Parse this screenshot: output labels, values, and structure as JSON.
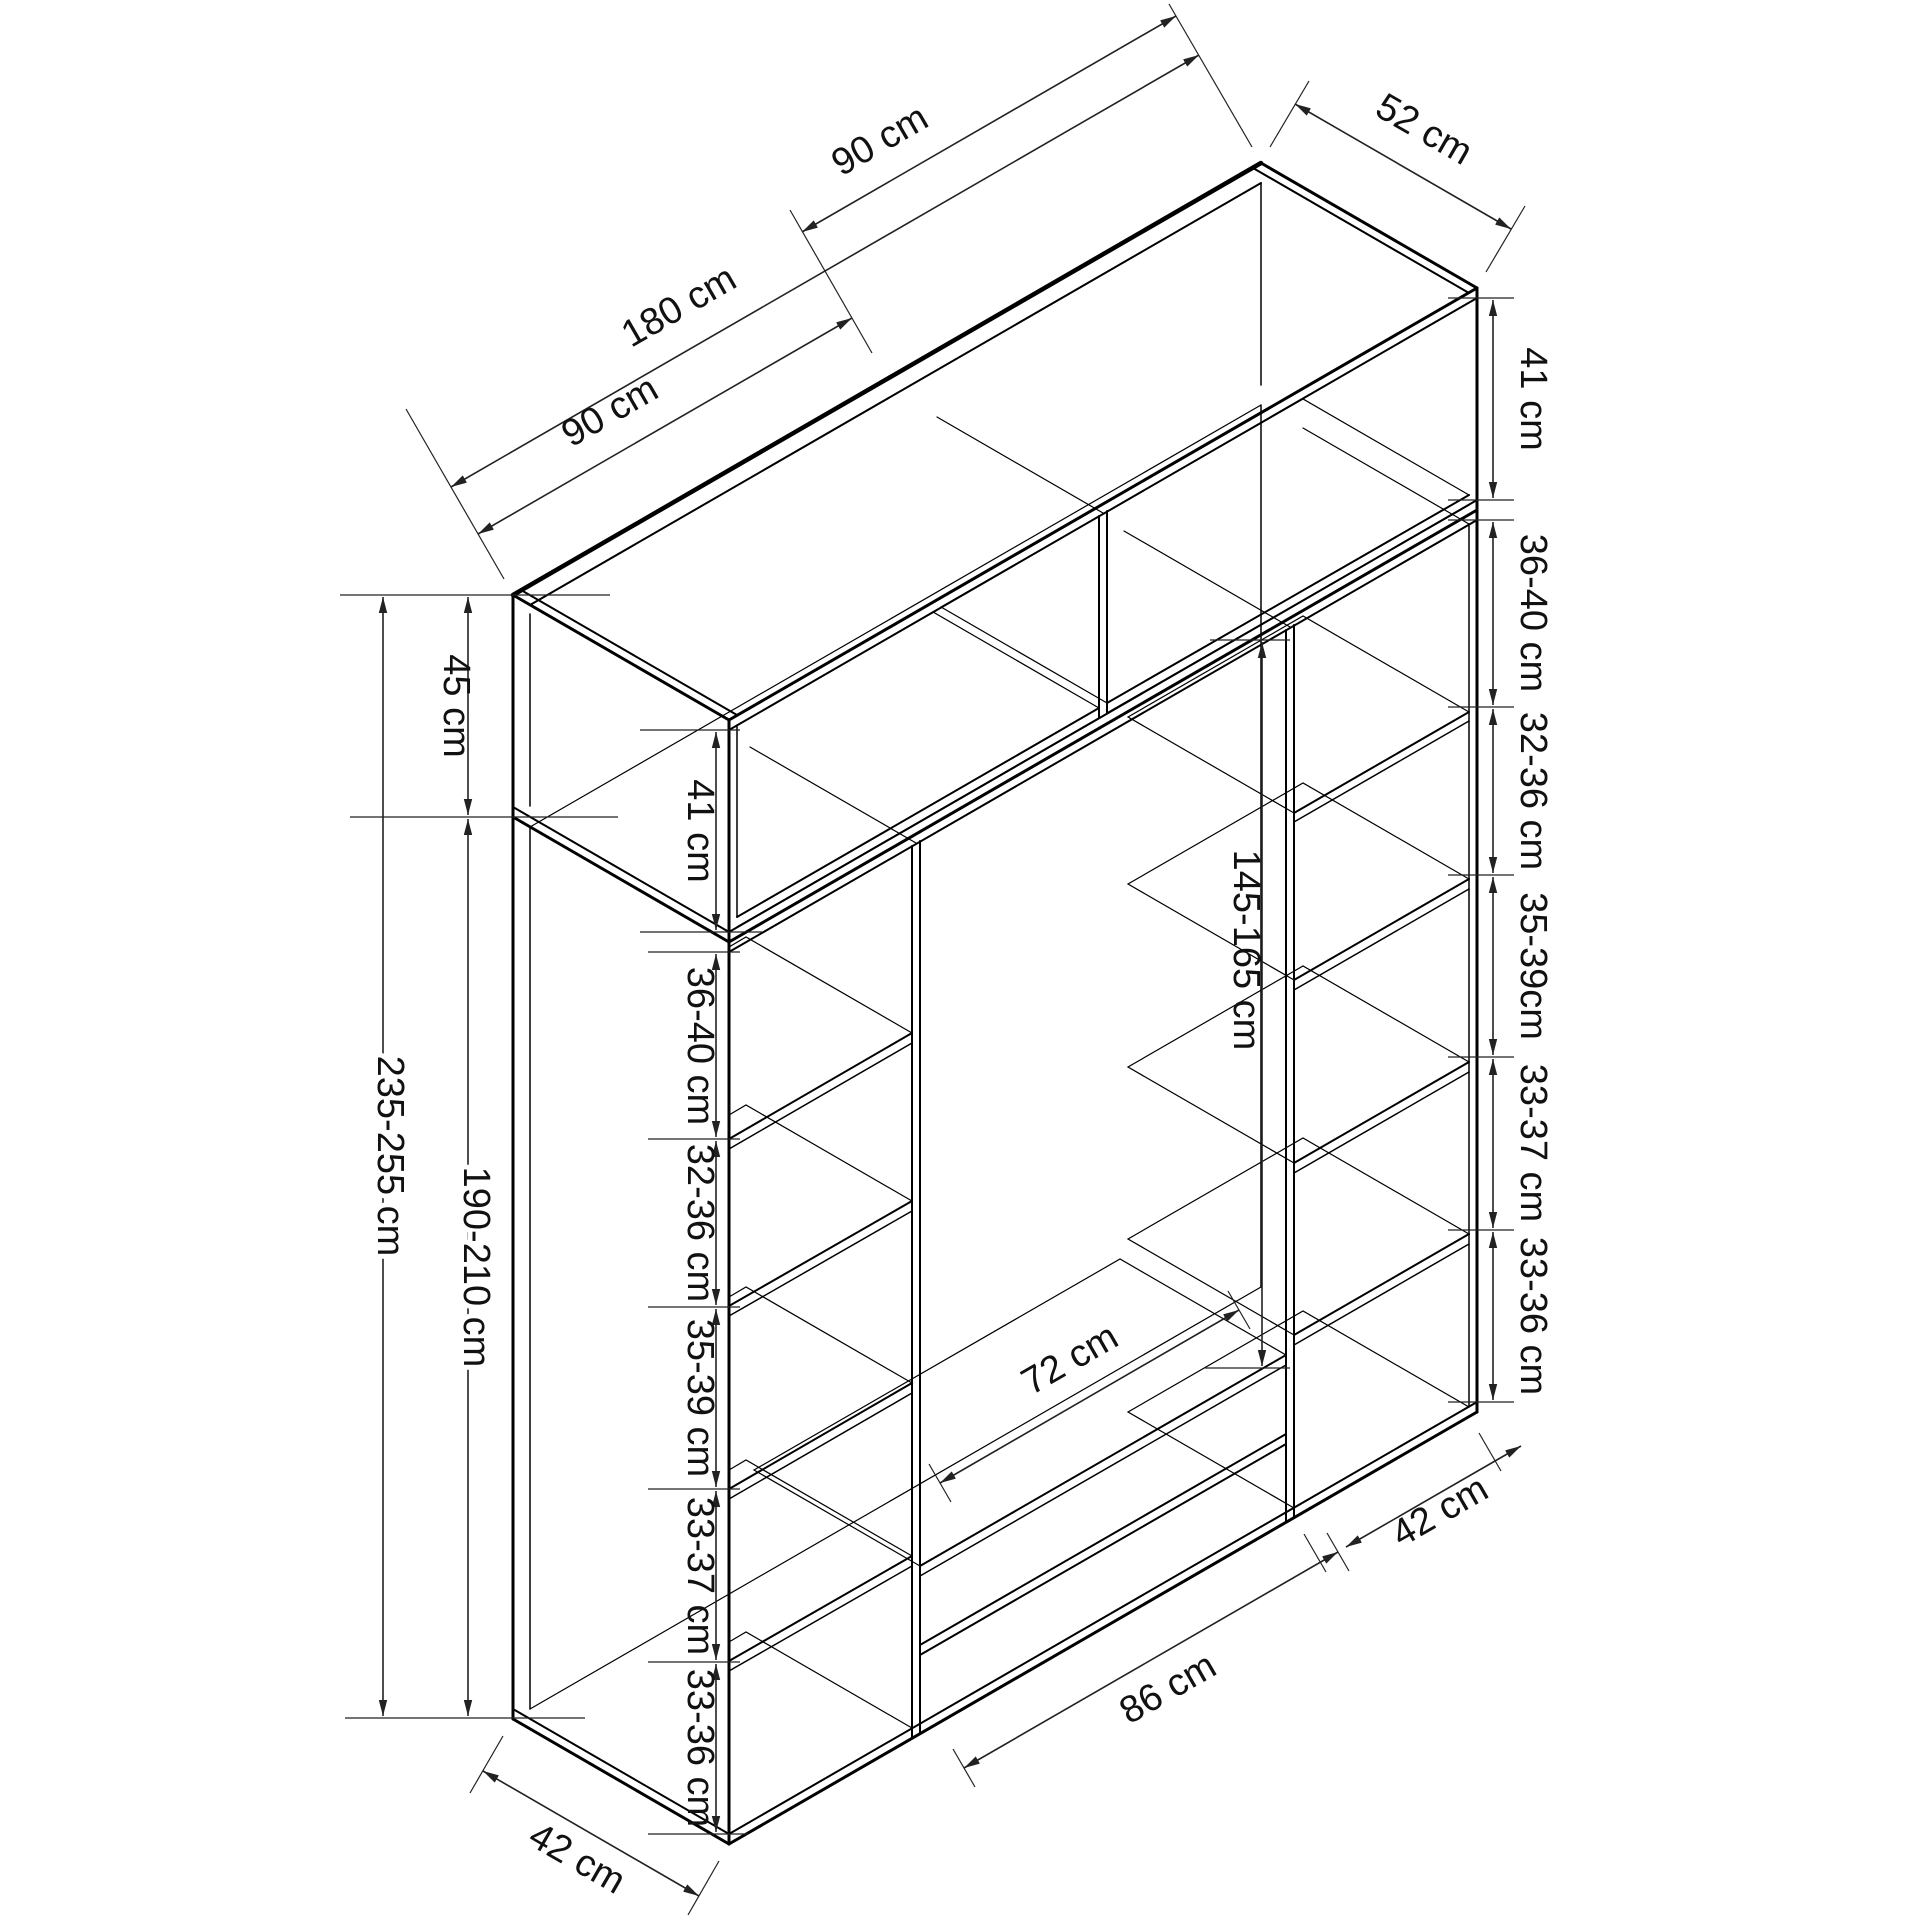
{
  "diagram": {
    "kind": "wardrobe-dimension-drawing",
    "unit": "cm",
    "top": {
      "left_half": "90 cm",
      "total": "180 cm",
      "right_half": "90 cm",
      "depth": "52 cm"
    },
    "left_outer": {
      "top_section_height": "45 cm",
      "total_height": "235-255 cm",
      "body_height": "190-210 cm"
    },
    "left_column": {
      "top_box_interior": "41 cm",
      "shelves": [
        "36-40 cm",
        "32-36 cm",
        "35-39 cm",
        "33-37 cm",
        "33-36 cm"
      ],
      "bottom_depth": "42 cm"
    },
    "right_column": {
      "top_box_interior": "41 cm",
      "shelves": [
        "36-40 cm",
        "32-36 cm",
        "35-39cm",
        "33-37 cm",
        "33-36 cm"
      ],
      "bottom_width": "42 cm"
    },
    "middle": {
      "hanging_height": "145-165 cm",
      "drawer_width": "72 cm",
      "bottom_width": "86 cm"
    }
  }
}
